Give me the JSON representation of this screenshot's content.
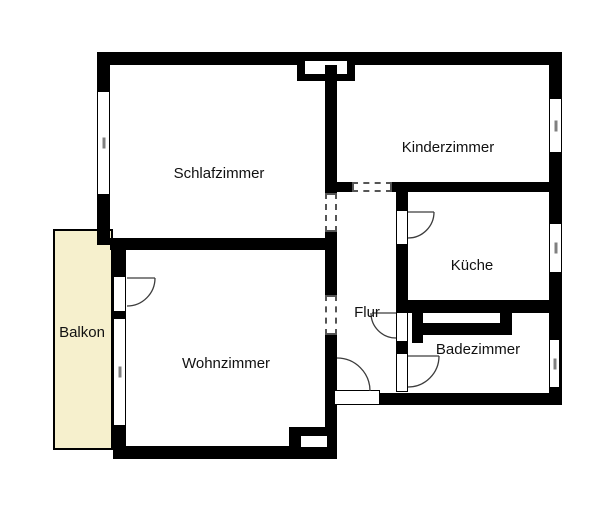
{
  "plan": {
    "type": "apartment-floor-plan",
    "language": "de"
  },
  "rooms": [
    {
      "id": "schlafzimmer",
      "label": "Schlafzimmer"
    },
    {
      "id": "kinderzimmer",
      "label": "Kinderzimmer"
    },
    {
      "id": "kueche",
      "label": "Küche"
    },
    {
      "id": "flur",
      "label": "Flur"
    },
    {
      "id": "badezimmer",
      "label": "Badezimmer"
    },
    {
      "id": "wohnzimmer",
      "label": "Wohnzimmer"
    },
    {
      "id": "balkon",
      "label": "Balkon"
    }
  ],
  "doors": [
    {
      "name": "balkon-door"
    },
    {
      "name": "kueche-door"
    },
    {
      "name": "flur-door"
    },
    {
      "name": "badezimmer-door"
    },
    {
      "name": "entrance-door"
    }
  ],
  "windows": [
    {
      "name": "schlafzimmer-window"
    },
    {
      "name": "kinderzimmer-window"
    },
    {
      "name": "kueche-window"
    },
    {
      "name": "badezimmer-window"
    },
    {
      "name": "wohnzimmer-balkon-window"
    }
  ],
  "wall_openings": [
    {
      "name": "schlafzimmer-flur-opening",
      "style": "dashed"
    },
    {
      "name": "wohnzimmer-flur-opening",
      "style": "dashed"
    },
    {
      "name": "kinderzimmer-flur-opening",
      "style": "dashed"
    }
  ],
  "colors": {
    "wall": "#000000",
    "balcony_fill": "#f6f0cd",
    "background": "#ffffff",
    "door_arc": "#3c3c3c",
    "window_tick": "#808080",
    "opening_dash": "#555555"
  }
}
